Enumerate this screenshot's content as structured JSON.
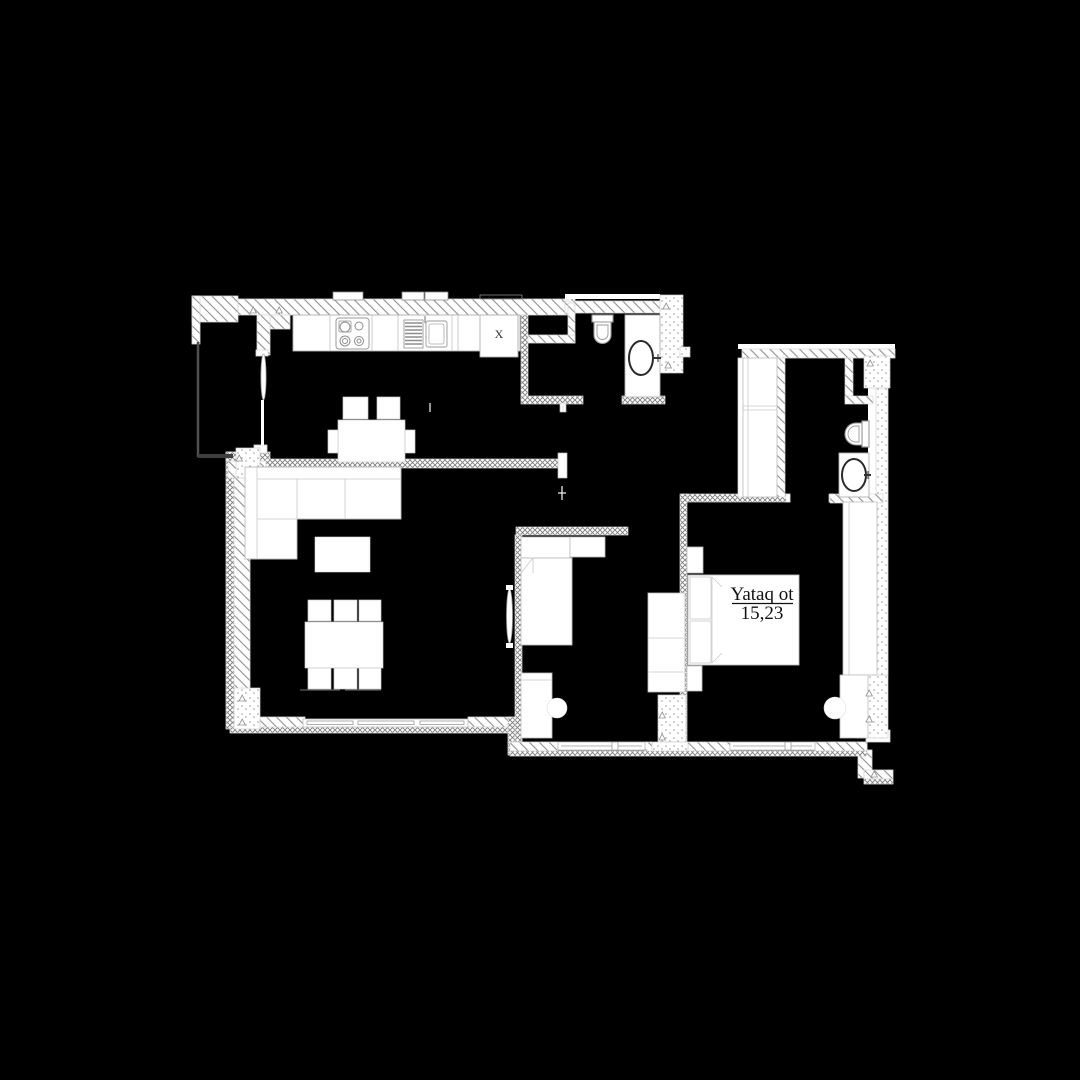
{
  "page": {
    "background_color": "#000000"
  },
  "floor_plan": {
    "type": "apartment-floor-plan",
    "rooms": {
      "bedroom": {
        "name": "Yataq ot",
        "area_m2": "15,23"
      }
    },
    "markers": {
      "refrigerator": "X"
    },
    "fixtures": [
      "stove",
      "kitchen-sink",
      "refrigerator",
      "kitchen-table",
      "dining-table",
      "sofa",
      "coffee-table",
      "toilet",
      "washbasin",
      "closet-cabinet",
      "single-bed",
      "head-shelf",
      "desk",
      "desk-chair",
      "wardrobe",
      "double-bed",
      "pillows",
      "nightstand",
      "pouf",
      "balcony",
      "windows",
      "door-leaf"
    ],
    "colors": {
      "background": "#000000",
      "wall_fill": "#ffffff",
      "hatch_line": "#8f8f8f",
      "furniture_outline": "#b5b5b5",
      "fixture_outline": "#8d8d8d",
      "balcony_outline": "#4f4f4f",
      "label_text": "#111111"
    }
  }
}
